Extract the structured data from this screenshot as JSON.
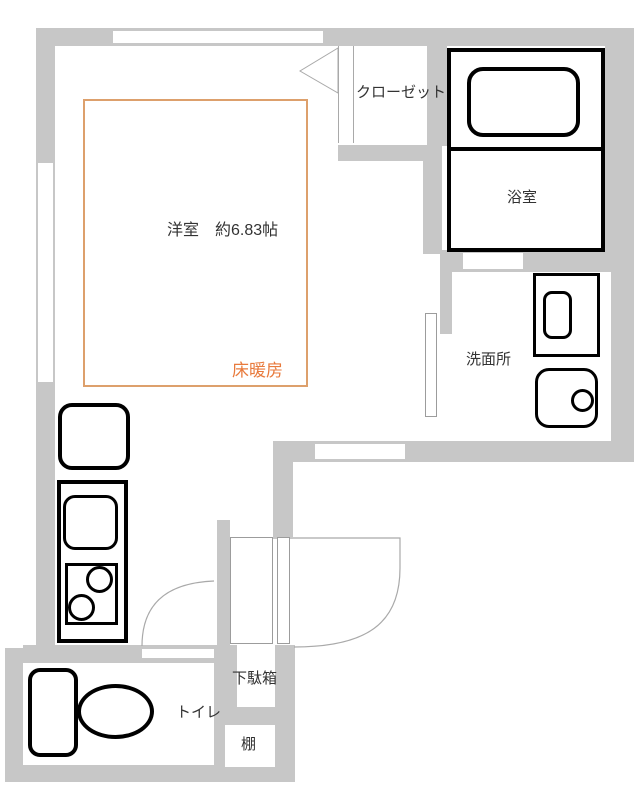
{
  "plan_type": "floor_plan",
  "rooms": {
    "main_room": {
      "label": "洋室　約6.83帖"
    },
    "floor_heating": {
      "label": "床暖房"
    },
    "closet": {
      "label": "クローゼット"
    },
    "bathroom": {
      "label": "浴室"
    },
    "washroom": {
      "label": "洗面所"
    },
    "toilet": {
      "label": "トイレ"
    },
    "shoe_cabinet": {
      "label": "下駄箱"
    },
    "shelf": {
      "label": "棚"
    }
  },
  "colors": {
    "wall": "#c7c7c7",
    "thin_line": "#a9a9a9",
    "fixture_outline": "#000000",
    "floor_heating_text": "#e87a3c",
    "floor_heating_border": "#dda06c"
  }
}
